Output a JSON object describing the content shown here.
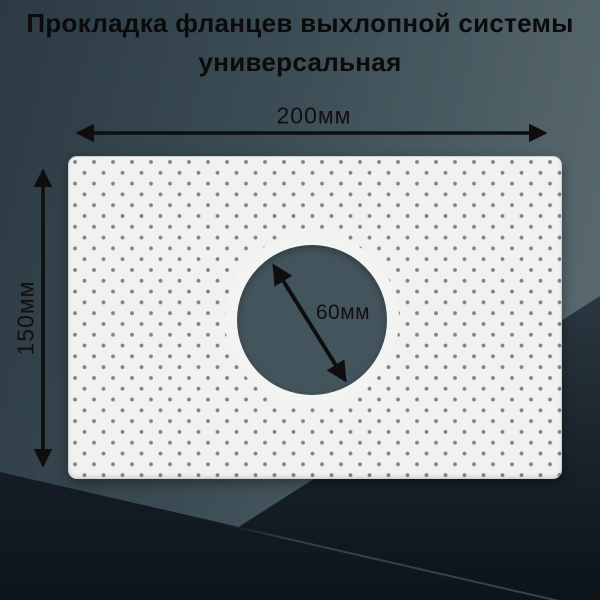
{
  "title": {
    "line1": "Прокладка фланцев выхлопной системы",
    "line2": "универсальная"
  },
  "dimensions": {
    "width_label": "200мм",
    "height_label": "150мм",
    "hole_diameter_label": "60мм"
  },
  "product": {
    "type": "перфорированная прокладка",
    "shape": "прямоугольник с круглым отверстием по центру"
  },
  "colors": {
    "background_teal_dark": "#2c3b43",
    "background_teal_light": "#5e6e74",
    "background_bottom_dark": "#0d141c",
    "gasket": "#f1f1ef",
    "perforation_dots": "#7e838a",
    "hole_backdrop": "#44545c",
    "arrow": "#0e0e0e",
    "title_text": "#0b0b0b"
  },
  "icons": {
    "width_arrow": "double-headed-horizontal-arrow",
    "height_arrow": "double-headed-vertical-arrow",
    "hole_arrow": "double-headed-diagonal-arrow"
  }
}
